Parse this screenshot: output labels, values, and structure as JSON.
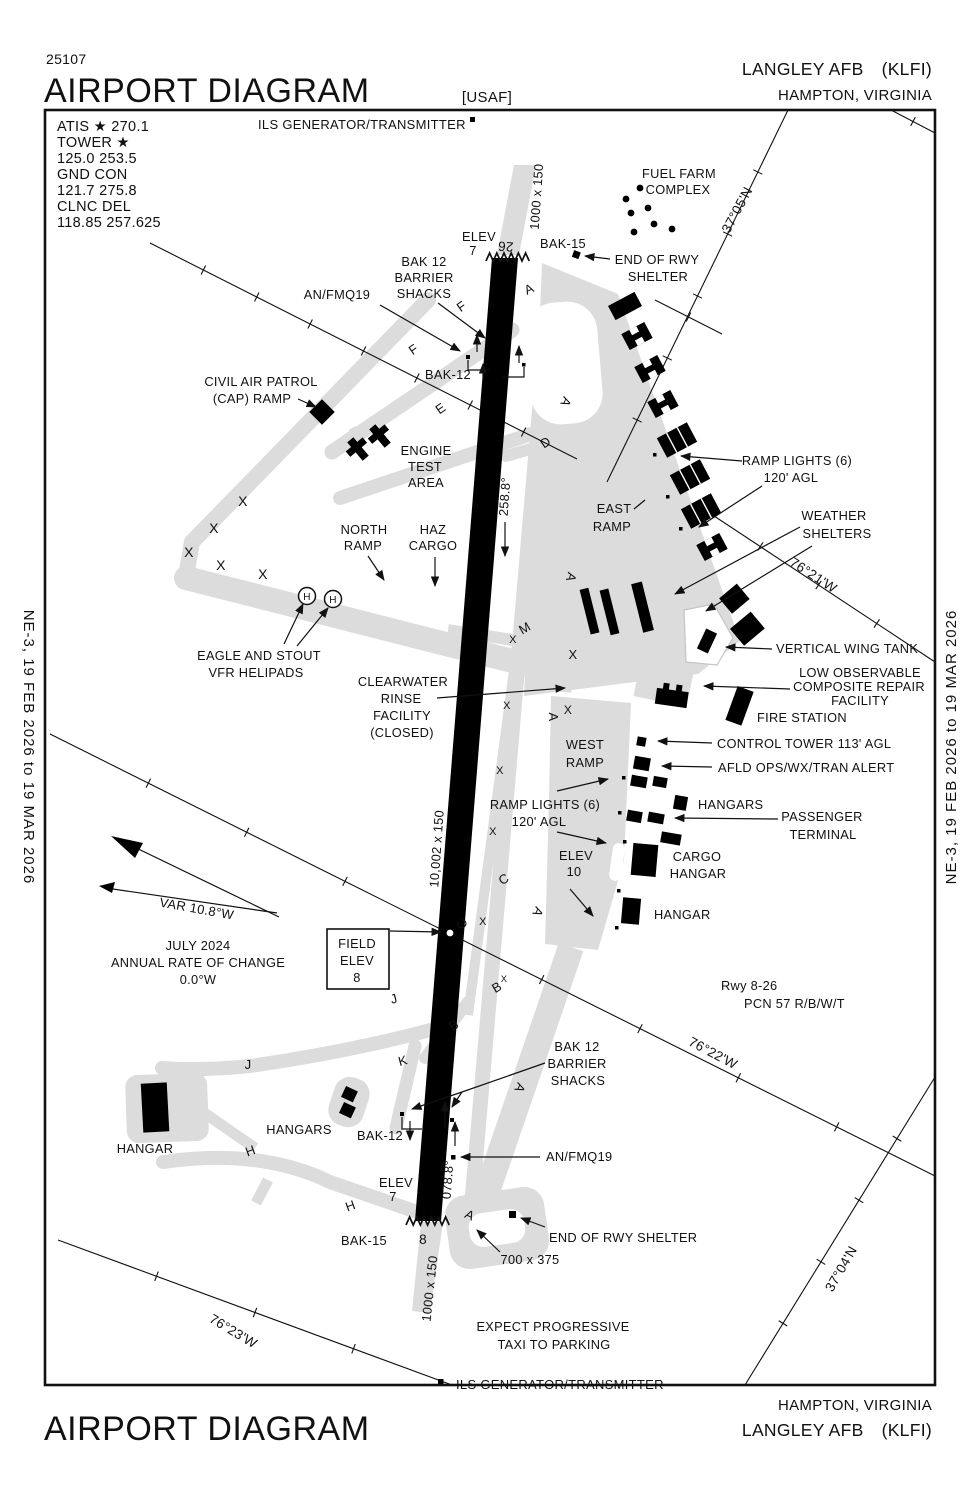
{
  "header": {
    "chart_number": "25107",
    "title": "AIRPORT DIAGRAM",
    "org": "[USAF]",
    "airport_name": "LANGLEY AFB",
    "icao": "(KLFI)",
    "city": "HAMPTON, VIRGINIA"
  },
  "footer": {
    "title": "AIRPORT DIAGRAM",
    "city": "HAMPTON, VIRGINIA",
    "airport_name": "LANGLEY AFB",
    "icao": "(KLFI)"
  },
  "margins": {
    "left": "NE-3,  19 FEB 2026  to  19 MAR 2026",
    "right": "NE-3,  19 FEB 2026  to  19 MAR 2026"
  },
  "frequencies": {
    "lines": [
      "ATIS ★ 270.1",
      "TOWER ★",
      "125.0  253.5",
      "GND CON",
      "121.7  275.8",
      "CLNC DEL",
      "118.85  257.625"
    ]
  },
  "runway": {
    "designator_ne": "26",
    "designator_sw": "8",
    "dimensions": "10,002 x 150",
    "heading_ne": "258.8°",
    "heading_sw": "078.8°",
    "pcn": "PCN 57 R/B/W/T",
    "field_elevation": "8"
  },
  "symbols": {
    "helipad_letter": "H"
  },
  "colors": {
    "ink": "#111111",
    "pavement": "#dcdcdc",
    "runway": "#000000"
  },
  "labels": [
    {
      "id": "ils-top",
      "text": "ILS GENERATOR/TRANSMITTER",
      "x": 258,
      "y": 129,
      "anchor": "start",
      "size": 13
    },
    {
      "id": "fuel-farm-1",
      "text": "FUEL FARM",
      "x": 679,
      "y": 178
    },
    {
      "id": "fuel-farm-2",
      "text": "COMPLEX",
      "x": 678,
      "y": 194
    },
    {
      "id": "lat-3705",
      "text": "37°05'N",
      "x": 741,
      "y": 212,
      "rot": -62,
      "size": 13.5
    },
    {
      "id": "bak15-top",
      "text": "BAK-15",
      "x": 563,
      "y": 248
    },
    {
      "id": "end-rwy-top-1",
      "text": "END OF RWY",
      "x": 657,
      "y": 264
    },
    {
      "id": "end-rwy-top-2",
      "text": "SHELTER",
      "x": 658,
      "y": 281
    },
    {
      "id": "elev-top-1",
      "text": "ELEV",
      "x": 479,
      "y": 241
    },
    {
      "id": "elev-top-2",
      "text": "7",
      "x": 473,
      "y": 255
    },
    {
      "id": "rwy-26",
      "text": "26",
      "x": 506,
      "y": 242,
      "rot": 184,
      "size": 13.5
    },
    {
      "id": "dim-top",
      "text": "1000 x 150",
      "x": 541,
      "y": 197,
      "rot": -86
    },
    {
      "id": "shacks-top-1",
      "text": "BAK 12",
      "x": 424,
      "y": 266
    },
    {
      "id": "shacks-top-2",
      "text": "BARRIER",
      "x": 424,
      "y": 282
    },
    {
      "id": "shacks-top-3",
      "text": "SHACKS",
      "x": 424,
      "y": 298
    },
    {
      "id": "anfmq19-top",
      "text": "AN/FMQ19",
      "x": 337,
      "y": 299
    },
    {
      "id": "bak12-top",
      "text": "BAK-12",
      "x": 448,
      "y": 379
    },
    {
      "id": "cap-1",
      "text": "CIVIL AIR PATROL",
      "x": 261,
      "y": 386
    },
    {
      "id": "cap-2",
      "text": "(CAP) RAMP",
      "x": 252,
      "y": 403
    },
    {
      "id": "engine-1",
      "text": "ENGINE",
      "x": 426,
      "y": 455
    },
    {
      "id": "engine-2",
      "text": "TEST",
      "x": 425,
      "y": 471
    },
    {
      "id": "engine-3",
      "text": "AREA",
      "x": 426,
      "y": 487
    },
    {
      "id": "north-ramp-1",
      "text": "NORTH",
      "x": 364,
      "y": 534
    },
    {
      "id": "north-ramp-2",
      "text": "RAMP",
      "x": 363,
      "y": 550
    },
    {
      "id": "haz-1",
      "text": "HAZ",
      "x": 433,
      "y": 534
    },
    {
      "id": "haz-2",
      "text": "CARGO",
      "x": 433,
      "y": 550
    },
    {
      "id": "east-ramp-1",
      "text": "EAST",
      "x": 614,
      "y": 513
    },
    {
      "id": "east-ramp-2",
      "text": "RAMP",
      "x": 612,
      "y": 531
    },
    {
      "id": "hdg-258",
      "text": "258.8°",
      "x": 509,
      "y": 497,
      "rot": -86
    },
    {
      "id": "ramp-lights-top-1",
      "text": "RAMP LIGHTS (6)",
      "x": 797,
      "y": 465
    },
    {
      "id": "ramp-lights-top-2",
      "text": "120' AGL",
      "x": 791,
      "y": 482
    },
    {
      "id": "weather-1",
      "text": "WEATHER",
      "x": 834,
      "y": 520
    },
    {
      "id": "weather-2",
      "text": "SHELTERS",
      "x": 837,
      "y": 538
    },
    {
      "id": "lon-7621",
      "text": "76°21'W",
      "x": 811,
      "y": 579,
      "rot": 33,
      "size": 13.5
    },
    {
      "id": "eagle-1",
      "text": "EAGLE AND STOUT",
      "x": 259,
      "y": 660
    },
    {
      "id": "eagle-2",
      "text": "VFR HELIPADS",
      "x": 256,
      "y": 677
    },
    {
      "id": "clearwater-1",
      "text": "CLEARWATER",
      "x": 403,
      "y": 686
    },
    {
      "id": "clearwater-2",
      "text": "RINSE",
      "x": 401,
      "y": 703
    },
    {
      "id": "clearwater-3",
      "text": "FACILITY",
      "x": 402,
      "y": 720
    },
    {
      "id": "clearwater-4",
      "text": "(CLOSED)",
      "x": 402,
      "y": 737
    },
    {
      "id": "vert-wing-tank",
      "text": "VERTICAL WING TANK",
      "x": 776,
      "y": 653,
      "anchor": "start"
    },
    {
      "id": "lowobs-1",
      "text": "LOW OBSERVABLE",
      "x": 860,
      "y": 677
    },
    {
      "id": "lowobs-2",
      "text": "COMPOSITE REPAIR",
      "x": 859,
      "y": 691
    },
    {
      "id": "lowobs-3",
      "text": "FACILITY",
      "x": 860,
      "y": 705
    },
    {
      "id": "fire-station",
      "text": "FIRE STATION",
      "x": 757,
      "y": 722,
      "anchor": "start"
    },
    {
      "id": "control-tower",
      "text": "CONTROL TOWER 113' AGL",
      "x": 717,
      "y": 748,
      "anchor": "start"
    },
    {
      "id": "afld-ops",
      "text": "AFLD OPS/WX/TRAN ALERT",
      "x": 718,
      "y": 772,
      "anchor": "start"
    },
    {
      "id": "west-ramp-1",
      "text": "WEST",
      "x": 585,
      "y": 749
    },
    {
      "id": "west-ramp-2",
      "text": "RAMP",
      "x": 585,
      "y": 767
    },
    {
      "id": "hangars-west",
      "text": "HANGARS",
      "x": 698,
      "y": 809,
      "anchor": "start"
    },
    {
      "id": "passenger-1",
      "text": "PASSENGER",
      "x": 822,
      "y": 821
    },
    {
      "id": "passenger-2",
      "text": "TERMINAL",
      "x": 823,
      "y": 839
    },
    {
      "id": "ramp-lights-mid-1",
      "text": "RAMP LIGHTS (6)",
      "x": 545,
      "y": 809
    },
    {
      "id": "ramp-lights-mid-2",
      "text": "120' AGL",
      "x": 539,
      "y": 826
    },
    {
      "id": "elev-10-1",
      "text": "ELEV",
      "x": 576,
      "y": 860
    },
    {
      "id": "elev-10-2",
      "text": "10",
      "x": 574,
      "y": 876
    },
    {
      "id": "cargo-1",
      "text": "CARGO",
      "x": 697,
      "y": 861
    },
    {
      "id": "cargo-2",
      "text": "HANGAR",
      "x": 698,
      "y": 878
    },
    {
      "id": "hangar-mid",
      "text": "HANGAR",
      "x": 654,
      "y": 919,
      "anchor": "start"
    },
    {
      "id": "field-elev-1",
      "text": "FIELD",
      "x": 357,
      "y": 948
    },
    {
      "id": "field-elev-2",
      "text": "ELEV",
      "x": 357,
      "y": 965
    },
    {
      "id": "field-elev-3",
      "text": "8",
      "x": 357,
      "y": 982
    },
    {
      "id": "var",
      "text": "VAR  10.8°W",
      "x": 196,
      "y": 913,
      "rot": 10,
      "size": 13
    },
    {
      "id": "july-1",
      "text": "JULY 2024",
      "x": 198,
      "y": 950
    },
    {
      "id": "july-2",
      "text": "ANNUAL RATE OF CHANGE",
      "x": 198,
      "y": 967
    },
    {
      "id": "july-3",
      "text": "0.0°W",
      "x": 198,
      "y": 984
    },
    {
      "id": "dim-main",
      "text": "10,002 x 150",
      "x": 441,
      "y": 849,
      "rot": -86
    },
    {
      "id": "pcn-1",
      "text": "Rwy 8-26",
      "x": 721,
      "y": 990,
      "anchor": "start"
    },
    {
      "id": "pcn-2",
      "text": "PCN 57 R/B/W/T",
      "x": 744,
      "y": 1008,
      "anchor": "start"
    },
    {
      "id": "lon-7622",
      "text": "76°22'W",
      "x": 711,
      "y": 1057,
      "rot": 28,
      "size": 13.5
    },
    {
      "id": "shacks-bot-1",
      "text": "BAK 12",
      "x": 577,
      "y": 1051
    },
    {
      "id": "shacks-bot-2",
      "text": "BARRIER",
      "x": 577,
      "y": 1068
    },
    {
      "id": "shacks-bot-3",
      "text": "SHACKS",
      "x": 578,
      "y": 1085
    },
    {
      "id": "hangars-south",
      "text": "HANGARS",
      "x": 299,
      "y": 1134
    },
    {
      "id": "bak12-bot",
      "text": "BAK-12",
      "x": 380,
      "y": 1140
    },
    {
      "id": "anfmq19-bot",
      "text": "AN/FMQ19",
      "x": 546,
      "y": 1161,
      "anchor": "start"
    },
    {
      "id": "hangar-south",
      "text": "HANGAR",
      "x": 145,
      "y": 1153
    },
    {
      "id": "hdg-078",
      "text": "078.8°",
      "x": 452,
      "y": 1180,
      "rot": -86
    },
    {
      "id": "elev-bot-1",
      "text": "ELEV",
      "x": 396,
      "y": 1187
    },
    {
      "id": "elev-bot-2",
      "text": "7",
      "x": 393,
      "y": 1201
    },
    {
      "id": "end-rwy-bot",
      "text": "END OF RWY SHELTER",
      "x": 549,
      "y": 1242,
      "anchor": "start"
    },
    {
      "id": "dim-700",
      "text": "700 x 375",
      "x": 530,
      "y": 1264
    },
    {
      "id": "bak15-bot",
      "text": "BAK-15",
      "x": 364,
      "y": 1245
    },
    {
      "id": "rwy-8",
      "text": "8",
      "x": 423,
      "y": 1244,
      "size": 13.5
    },
    {
      "id": "dim-bot",
      "text": "1000 x 150",
      "x": 434,
      "y": 1289,
      "rot": -84
    },
    {
      "id": "lat-3704",
      "text": "37°04'N",
      "x": 845,
      "y": 1271,
      "rot": -60,
      "size": 13.5
    },
    {
      "id": "lon-7623",
      "text": "76°23'W",
      "x": 231,
      "y": 1335,
      "rot": 31,
      "size": 13.5
    },
    {
      "id": "expect-1",
      "text": "EXPECT PROGRESSIVE",
      "x": 553,
      "y": 1331
    },
    {
      "id": "expect-2",
      "text": "TAXI TO PARKING",
      "x": 554,
      "y": 1349
    },
    {
      "id": "ils-bot",
      "text": "ILS GENERATOR/TRANSMITTER",
      "x": 456,
      "y": 1389,
      "anchor": "start",
      "size": 13
    }
  ],
  "taxiway_letters": [
    {
      "ch": "A",
      "x": 531,
      "y": 293,
      "rot": -25
    },
    {
      "ch": "A",
      "x": 562,
      "y": 400,
      "rot": 115
    },
    {
      "ch": "A",
      "x": 567,
      "y": 576,
      "rot": 105
    },
    {
      "ch": "A",
      "x": 549,
      "y": 717,
      "rot": 90
    },
    {
      "ch": "A",
      "x": 534,
      "y": 910,
      "rot": 115
    },
    {
      "ch": "A",
      "x": 516,
      "y": 1086,
      "rot": 115
    },
    {
      "ch": "A",
      "x": 468,
      "y": 1219,
      "rot": 25
    },
    {
      "ch": "F",
      "x": 464,
      "y": 310,
      "rot": -35
    },
    {
      "ch": "F",
      "x": 416,
      "y": 353,
      "rot": -35
    },
    {
      "ch": "E",
      "x": 443,
      "y": 412,
      "rot": -35
    },
    {
      "ch": "D",
      "x": 548,
      "y": 446,
      "rot": -35
    },
    {
      "ch": "M",
      "x": 527,
      "y": 632,
      "rot": -30
    },
    {
      "ch": "C",
      "x": 506,
      "y": 883,
      "rot": -30
    },
    {
      "ch": "C",
      "x": 466,
      "y": 922,
      "rot": -115
    },
    {
      "ch": "B",
      "x": 456,
      "y": 1029,
      "rot": -30
    },
    {
      "ch": "B",
      "x": 499,
      "y": 991,
      "rot": -30
    },
    {
      "ch": "J",
      "x": 395,
      "y": 1003,
      "rot": -15
    },
    {
      "ch": "J",
      "x": 248,
      "y": 1069,
      "rot": 0
    },
    {
      "ch": "K",
      "x": 404,
      "y": 1065,
      "rot": -15
    },
    {
      "ch": "H",
      "x": 252,
      "y": 1155,
      "rot": -20
    },
    {
      "ch": "H",
      "x": 352,
      "y": 1210,
      "rot": -20
    }
  ],
  "x_marks": [
    {
      "x": 243,
      "y": 506,
      "s": 14
    },
    {
      "x": 214,
      "y": 533,
      "s": 14
    },
    {
      "x": 189,
      "y": 557,
      "s": 14
    },
    {
      "x": 221,
      "y": 570,
      "s": 14
    },
    {
      "x": 263,
      "y": 579,
      "s": 14
    },
    {
      "x": 573,
      "y": 659,
      "s": 13
    },
    {
      "x": 568,
      "y": 714,
      "s": 12
    },
    {
      "x": 513,
      "y": 643,
      "s": 11
    },
    {
      "x": 507,
      "y": 709,
      "s": 11
    },
    {
      "x": 500,
      "y": 774,
      "s": 11
    },
    {
      "x": 493,
      "y": 835,
      "s": 11
    },
    {
      "x": 483,
      "y": 925,
      "s": 11
    },
    {
      "x": 504,
      "y": 982,
      "s": 9
    }
  ]
}
